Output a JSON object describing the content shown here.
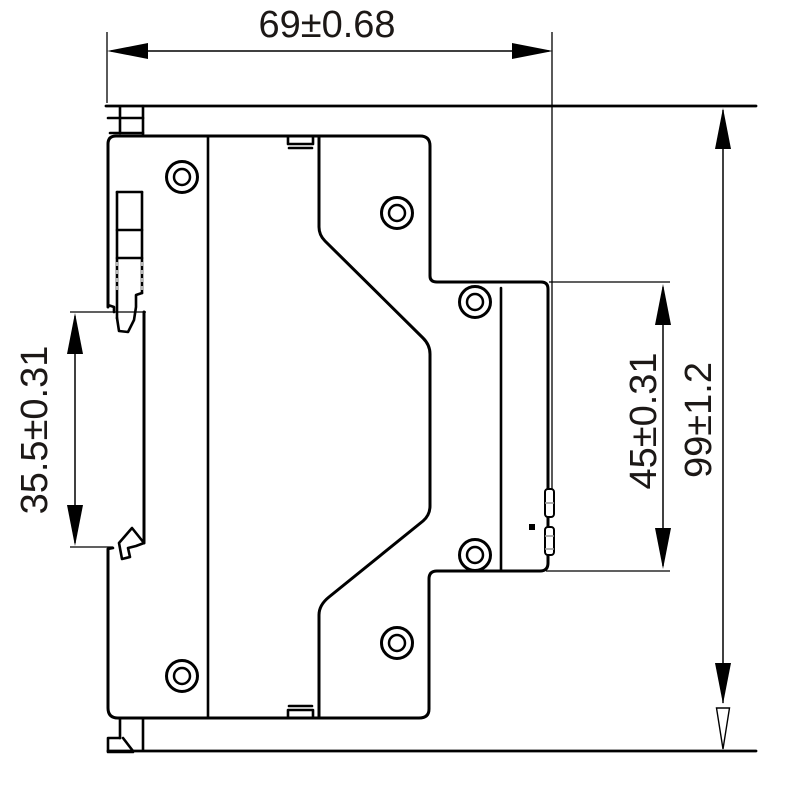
{
  "diagram": {
    "type": "technical-drawing",
    "description": "Side-view dimensional drawing of a DIN-rail mounted device with mounting panel reference lines",
    "background_color": "#ffffff",
    "line_color": "#000000",
    "dimensions": [
      {
        "id": "overall-width",
        "label": "69±0.68",
        "orientation": "horizontal",
        "position": "top"
      },
      {
        "id": "din-rail-height",
        "label": "35.5±0.31",
        "orientation": "vertical",
        "position": "left"
      },
      {
        "id": "terminal-height",
        "label": "45±0.31",
        "orientation": "vertical",
        "position": "right-inner"
      },
      {
        "id": "overall-height",
        "label": "99±1.2",
        "orientation": "vertical",
        "position": "right-outer"
      }
    ],
    "feature_counts": {
      "screw_bosses": 6,
      "panel_lines": 2
    }
  }
}
